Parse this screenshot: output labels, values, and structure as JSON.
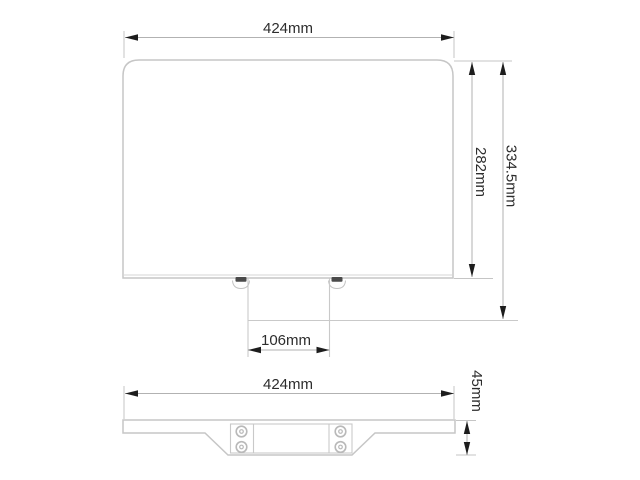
{
  "page": {
    "background_color": "#ffffff",
    "drawing_line_color": "#c6c6c6",
    "dimension_line_color": "#b2b2b2",
    "arrow_color": "#1d1d1d",
    "text_color": "#2d2d2d"
  },
  "front_view": {
    "width_dim": "424mm",
    "panel_height_dim": "282mm",
    "overall_height_dim": "334.5mm",
    "bracket_width_dim": "106mm"
  },
  "bottom_view": {
    "width_dim": "424mm",
    "thickness_dim": "45mm"
  }
}
